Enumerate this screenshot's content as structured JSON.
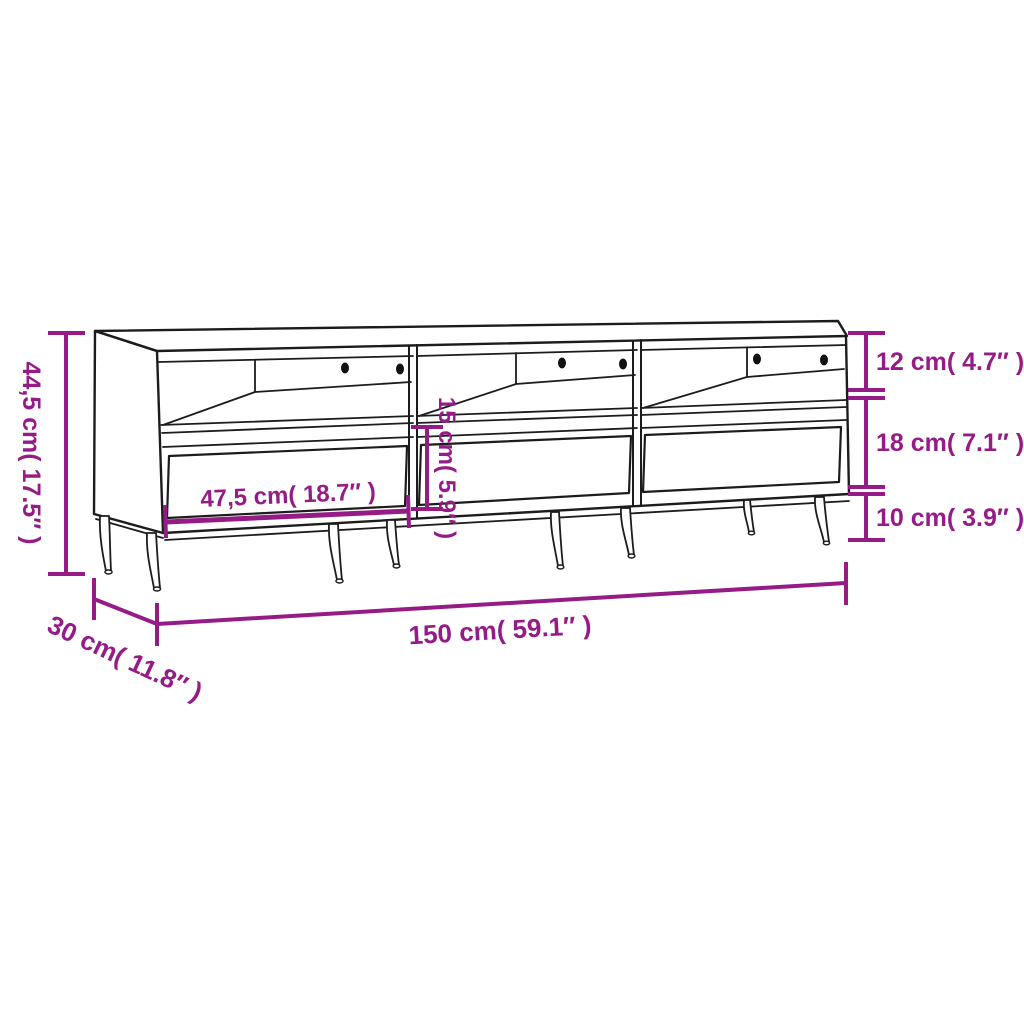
{
  "diagram": {
    "subject": "TV stand with 3 open compartments, 3 drawers and metal legs",
    "background_color": "#ffffff",
    "line_color": "#1c1c1c",
    "accent_color": "#951c87"
  },
  "dimensions": {
    "overall_height": {
      "label": "44,5 cm( 17.5″  )",
      "value_cm": 44.5,
      "value_in": 17.5
    },
    "compartment_height": {
      "label": "12 cm( 4.7″  )",
      "value_cm": 12,
      "value_in": 4.7
    },
    "drawer_section_height": {
      "label": "18 cm( 7.1″  )",
      "value_cm": 18,
      "value_in": 7.1
    },
    "leg_height": {
      "label": "10 cm( 3.9″  )",
      "value_cm": 10,
      "value_in": 3.9
    },
    "drawer_width": {
      "label": "47,5 cm( 18.7″  )",
      "value_cm": 47.5,
      "value_in": 18.7
    },
    "drawer_front_height": {
      "label": "15 cm( 5.9″  )",
      "value_cm": 15,
      "value_in": 5.9
    },
    "overall_width": {
      "label": "150 cm( 59.1″  )",
      "value_cm": 150,
      "value_in": 59.1
    },
    "overall_depth": {
      "label": "30 cm( 11.8″  )",
      "value_cm": 30,
      "value_in": 11.8
    }
  }
}
